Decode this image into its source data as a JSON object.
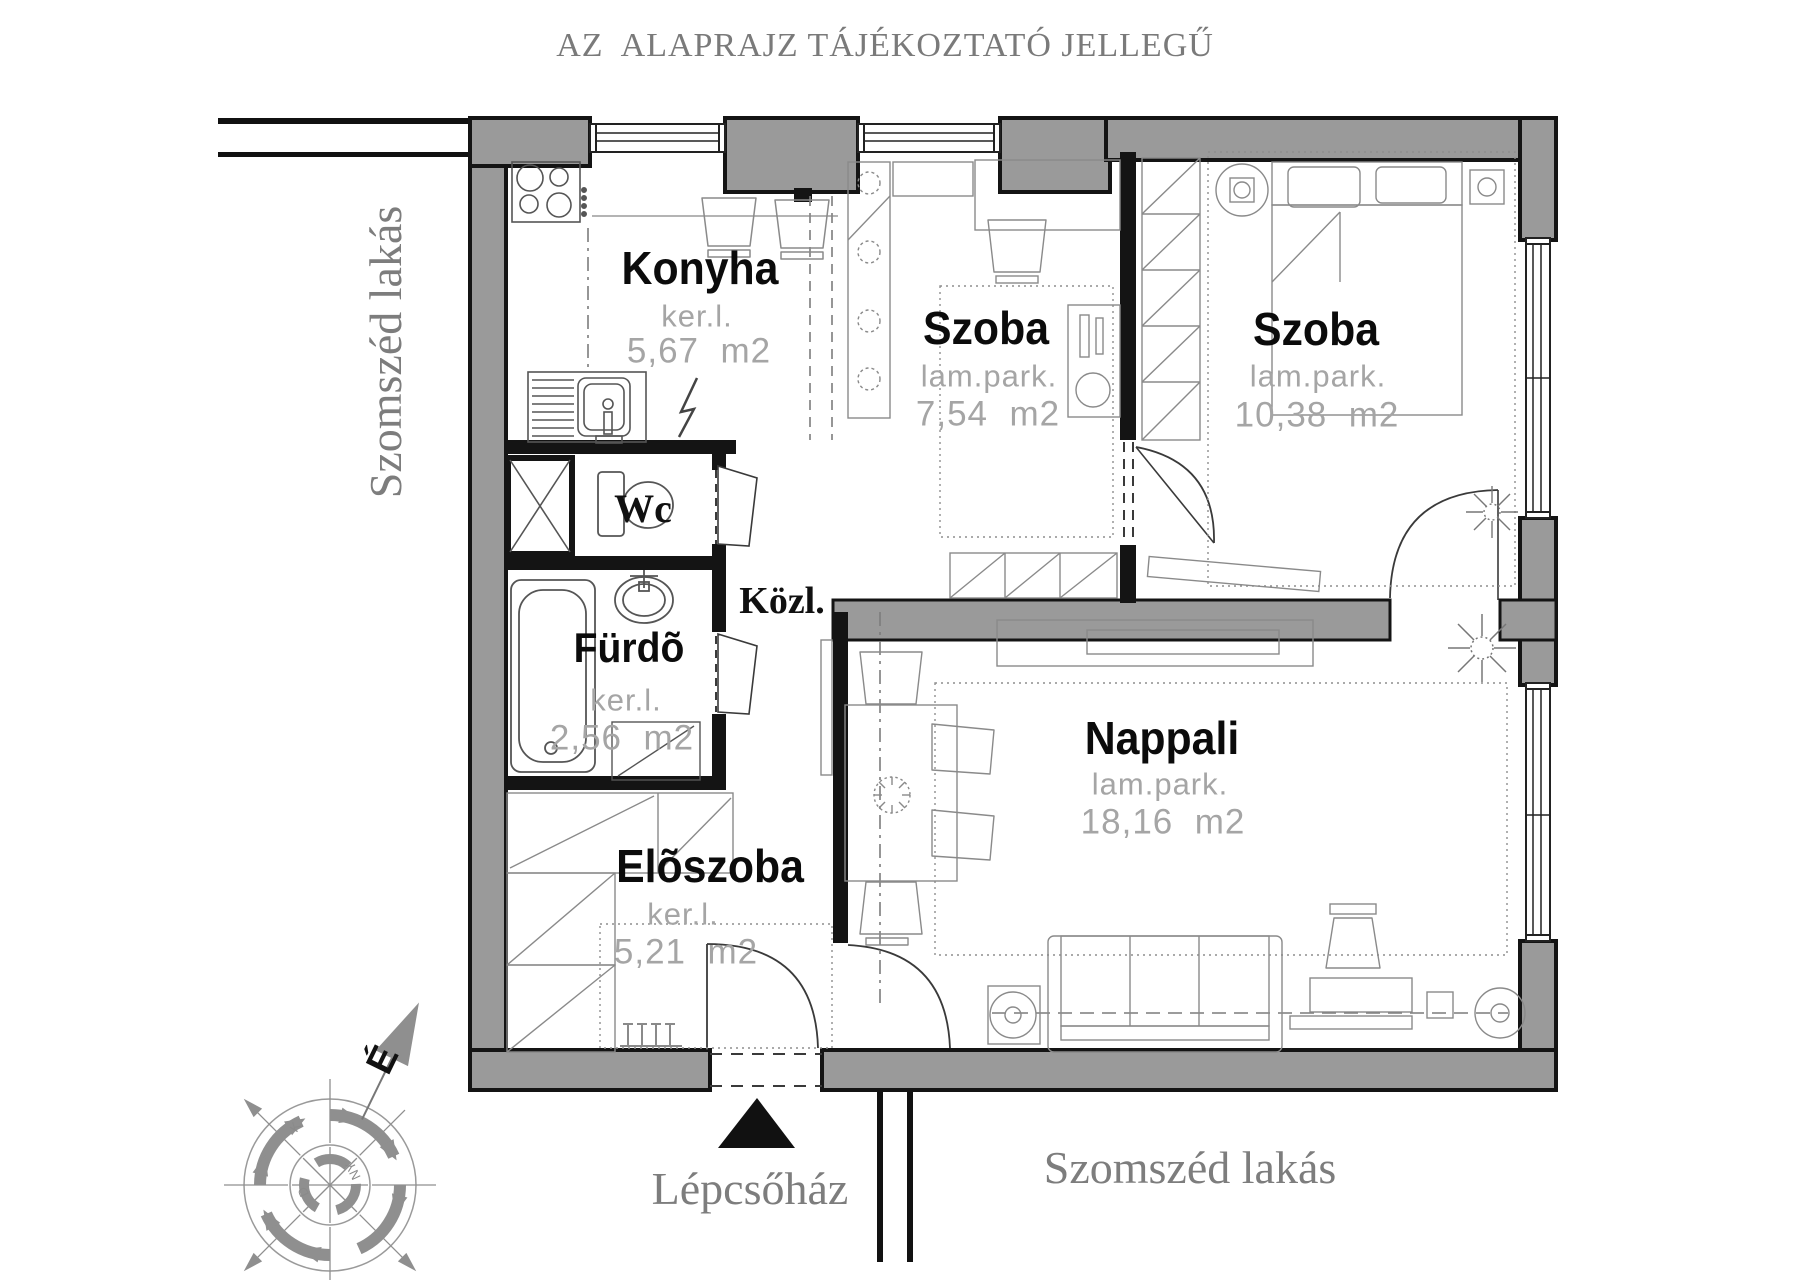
{
  "title": "AZ  ALAPRAJZ TÁJÉKOZTATÓ JELLEGŰ",
  "neighbor_left": "Szomszéd lakás",
  "neighbor_bottom": "Szomszéd lakás",
  "staircase": {
    "label": "Lépcsőház"
  },
  "rooms": {
    "konyha": {
      "name": "Konyha",
      "floor": "ker.l.",
      "area": "5,67  m2"
    },
    "szoba1": {
      "name": "Szoba",
      "floor": "lam.park.",
      "area": "7,54  m2"
    },
    "szoba2": {
      "name": "Szoba",
      "floor": "lam.park.",
      "area": "10,38  m2"
    },
    "wc": {
      "name": "Wc"
    },
    "furdo": {
      "name": "Fürdõ",
      "floor": "ker.l.",
      "area": "2,56  m2"
    },
    "kozl": {
      "name": "Közl."
    },
    "eloszoba": {
      "name": "Elõszoba",
      "floor": "ker.l.",
      "area": "5,21  m2"
    },
    "nappali": {
      "name": "Nappali",
      "floor": "lam.park.",
      "area": "18,16  m2"
    }
  },
  "compass": {
    "north": "É",
    "east": "K",
    "south": "D",
    "west": "NY"
  },
  "colors": {
    "wall": "#9a9a9a",
    "line": "#141414",
    "muted": "#a5a5a5",
    "label_gray": "#7d7d7d"
  }
}
